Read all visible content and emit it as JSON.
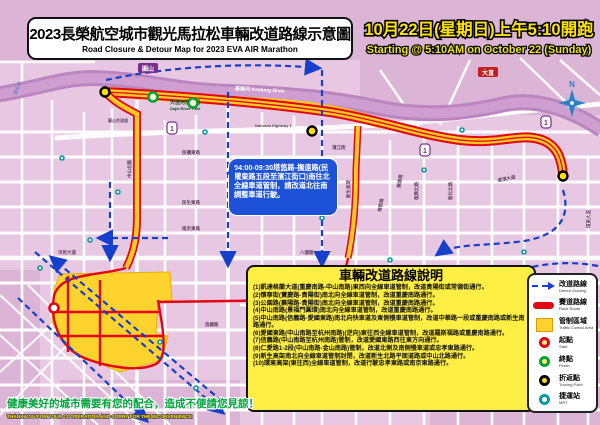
{
  "title": {
    "zh": "2023長榮航空城市觀光馬拉松車輛改道路線示意圖",
    "en": "Road Closure & Detour Map for 2023 EVA AIR Marathon"
  },
  "event_time": {
    "zh": "10月22日(星期日)上午5:10開跑",
    "en": "Starting @ 5:10AM on October 22 (Sunday)"
  },
  "notice_bubble": {
    "text": "04:00-09:30塔悠路-撫遠路(民權東路五段至濱江街口)南往北全線車道管制，請改道北往南調整車道行駛。"
  },
  "detour_panel": {
    "title": "車輛改道路線說明",
    "items": [
      "(1)凱達格蘭大道(重慶南路-中山南路)東西向全線車道管制，改道貴陽街或常德街通行。",
      "(2)懷寧街(寶慶路-貴陽街)南北向全線車道管制，改道重慶南路通行。",
      "(3)公園路(襄陽路-貴陽街)南北向全線車道管制，改道重慶南路通行。",
      "(4)中山南路(景福門圓環)南北向全線車道管制，改道重慶南路通行。",
      "(5)中山南路(信義路-愛國東路)南北向快車道及東側慢車道管制，改道中華路一段或重慶南路或新生南路通行。",
      "(6)愛國東路(中山南路至杭州南路)(逆向)東往西全線車道管制，改道羅斯福路或重慶南路通行。",
      "(7)信義路(中山南路至杭州南路)管制，改道愛國東路西往東方向通行。",
      "(8)仁愛路1-2段(中山南路-金山南路)管制，改道北側及南側慢車道或忠孝東路通行。",
      "(9)新生高架南北向全線車道管制封閉，改道新生北路平面道路或中山北路通行。",
      "(10)環東高架(東往西)全線車道管制，改道行駛忠孝東路或南京東路通行。"
    ]
  },
  "legend": {
    "items": [
      {
        "type": "detour",
        "zh": "改道路線",
        "en": "Detour Guiding"
      },
      {
        "type": "race",
        "zh": "賽道路線",
        "en": "Race Route"
      },
      {
        "type": "zone",
        "zh": "管制區域",
        "en": "Traffic Control Area"
      },
      {
        "type": "start",
        "zh": "起點",
        "en": "Start"
      },
      {
        "type": "finish",
        "zh": "終點",
        "en": "Finish"
      },
      {
        "type": "turn",
        "zh": "折返點",
        "en": "Turning Point"
      },
      {
        "type": "mrt",
        "zh": "捷運站",
        "en": "MRT"
      }
    ]
  },
  "slogan": {
    "zh": "健康美好的城市需要有您的配合，造成不便請您見諒！",
    "en": "THANK YOU FOR YOUR COOPERATION AND SORRY FOR THE INCONVENIENCE"
  },
  "compass": {
    "label": "N"
  },
  "map": {
    "labels": [
      {
        "t": "基隆河  Keelung River",
        "x": 235,
        "y": 90,
        "s": 5,
        "c": "#ffffff",
        "r": 3
      },
      {
        "t": "大佳河濱公園",
        "x": 170,
        "y": 104,
        "s": 5,
        "c": "#00551e",
        "r": 0
      },
      {
        "t": "Dajia River Park",
        "x": 170,
        "y": 110,
        "s": 4,
        "c": "#00551e",
        "r": 0
      },
      {
        "t": "National Highway 1",
        "x": 255,
        "y": 127,
        "s": 4,
        "c": "#555555",
        "r": 0
      },
      {
        "t": "圓山交流道",
        "x": 108,
        "y": 122,
        "s": 4,
        "c": "#664466",
        "r": 0
      },
      {
        "t": "中山北路",
        "x": 131,
        "y": 178,
        "s": 4.5,
        "c": "#664466",
        "r": -90
      },
      {
        "t": "松江路",
        "x": 234,
        "y": 196,
        "s": 4.5,
        "c": "#664466",
        "r": -90
      },
      {
        "t": "新生高架",
        "x": 350,
        "y": 198,
        "s": 4.5,
        "c": "#664466",
        "r": -90
      },
      {
        "t": "民權東路",
        "x": 182,
        "y": 154,
        "s": 4.5,
        "c": "#664466",
        "r": 0
      },
      {
        "t": "民生東路",
        "x": 182,
        "y": 204,
        "s": 4.5,
        "c": "#664466",
        "r": 0
      },
      {
        "t": "南京東路",
        "x": 182,
        "y": 230,
        "s": 4.5,
        "c": "#664466",
        "r": 0
      },
      {
        "t": "市民大道",
        "x": 58,
        "y": 254,
        "s": 4.5,
        "c": "#664466",
        "r": 0
      },
      {
        "t": "八德路",
        "x": 300,
        "y": 254,
        "s": 4.5,
        "c": "#664466",
        "r": 0
      },
      {
        "t": "忠孝東路",
        "x": 422,
        "y": 279,
        "s": 4.5,
        "c": "#664466",
        "r": 0
      },
      {
        "t": "仁愛路",
        "x": 272,
        "y": 300,
        "s": 4.5,
        "c": "#664466",
        "r": 0
      },
      {
        "t": "信義路",
        "x": 205,
        "y": 326,
        "s": 4.5,
        "c": "#664466",
        "r": 0
      },
      {
        "t": "和平東路",
        "x": 330,
        "y": 381,
        "s": 4.5,
        "c": "#664466",
        "r": 0
      },
      {
        "t": "復興北路",
        "x": 418,
        "y": 200,
        "s": 4.5,
        "c": "#664466",
        "r": -90
      },
      {
        "t": "敦化北路",
        "x": 452,
        "y": 200,
        "s": 4.5,
        "c": "#664466",
        "r": -90
      },
      {
        "t": "基隆路",
        "x": 540,
        "y": 330,
        "s": 4.5,
        "c": "#664466",
        "r": -70
      },
      {
        "t": "環東大道",
        "x": 590,
        "y": 228,
        "s": 4.5,
        "c": "#664466",
        "r": -90
      },
      {
        "t": "堤頂大道",
        "x": 498,
        "y": 182,
        "s": 4.5,
        "c": "#664466",
        "r": -12
      },
      {
        "t": "塔悠路",
        "x": 381,
        "y": 212,
        "s": 4.5,
        "c": "#664466",
        "r": -80
      },
      {
        "t": "撫遠路",
        "x": 400,
        "y": 188,
        "s": 4.5,
        "c": "#664466",
        "r": -80
      },
      {
        "t": "濱江街",
        "x": 332,
        "y": 149,
        "s": 4.5,
        "c": "#664466",
        "r": 0
      },
      {
        "t": "淡水河",
        "x": 16,
        "y": 95,
        "s": 4.5,
        "c": "#6688bb",
        "r": -65
      }
    ],
    "station_boxes": [
      {
        "t": "圓山",
        "x": 148,
        "y": 70,
        "bg": "#7a2d8c"
      },
      {
        "t": "大直",
        "x": 488,
        "y": 74,
        "bg": "#c4201e"
      }
    ],
    "highway_shields": [
      {
        "x": 172,
        "y": 128,
        "label": "1"
      },
      {
        "x": 425,
        "y": 150,
        "label": "1"
      },
      {
        "x": 546,
        "y": 122,
        "label": "1"
      }
    ],
    "mrt_stations": [
      [
        40,
        268
      ],
      [
        90,
        240
      ],
      [
        118,
        192
      ],
      [
        62,
        158
      ],
      [
        205,
        132
      ],
      [
        262,
        205
      ],
      [
        322,
        218
      ],
      [
        390,
        260
      ],
      [
        424,
        170
      ],
      [
        462,
        130
      ],
      [
        524,
        252
      ],
      [
        160,
        342
      ],
      [
        262,
        370
      ],
      [
        470,
        300
      ],
      [
        196,
        388
      ]
    ],
    "markers": {
      "turning_points": [
        [
          105,
          92
        ],
        [
          312,
          131
        ],
        [
          563,
          176
        ]
      ],
      "finish_points": [
        [
          153,
          97
        ],
        [
          193,
          103
        ]
      ],
      "start_point": [
        54,
        308
      ]
    }
  },
  "colors": {
    "map_bg": "#e7c7e2",
    "river": "#bb86bf",
    "race_red": "#e30613",
    "control_yellow": "#ffd22e",
    "detour_blue": "#1540cc",
    "panel_yellow": "#ffee44",
    "date_yellow": "#ffe400",
    "slogan_green": "#00a33c"
  }
}
